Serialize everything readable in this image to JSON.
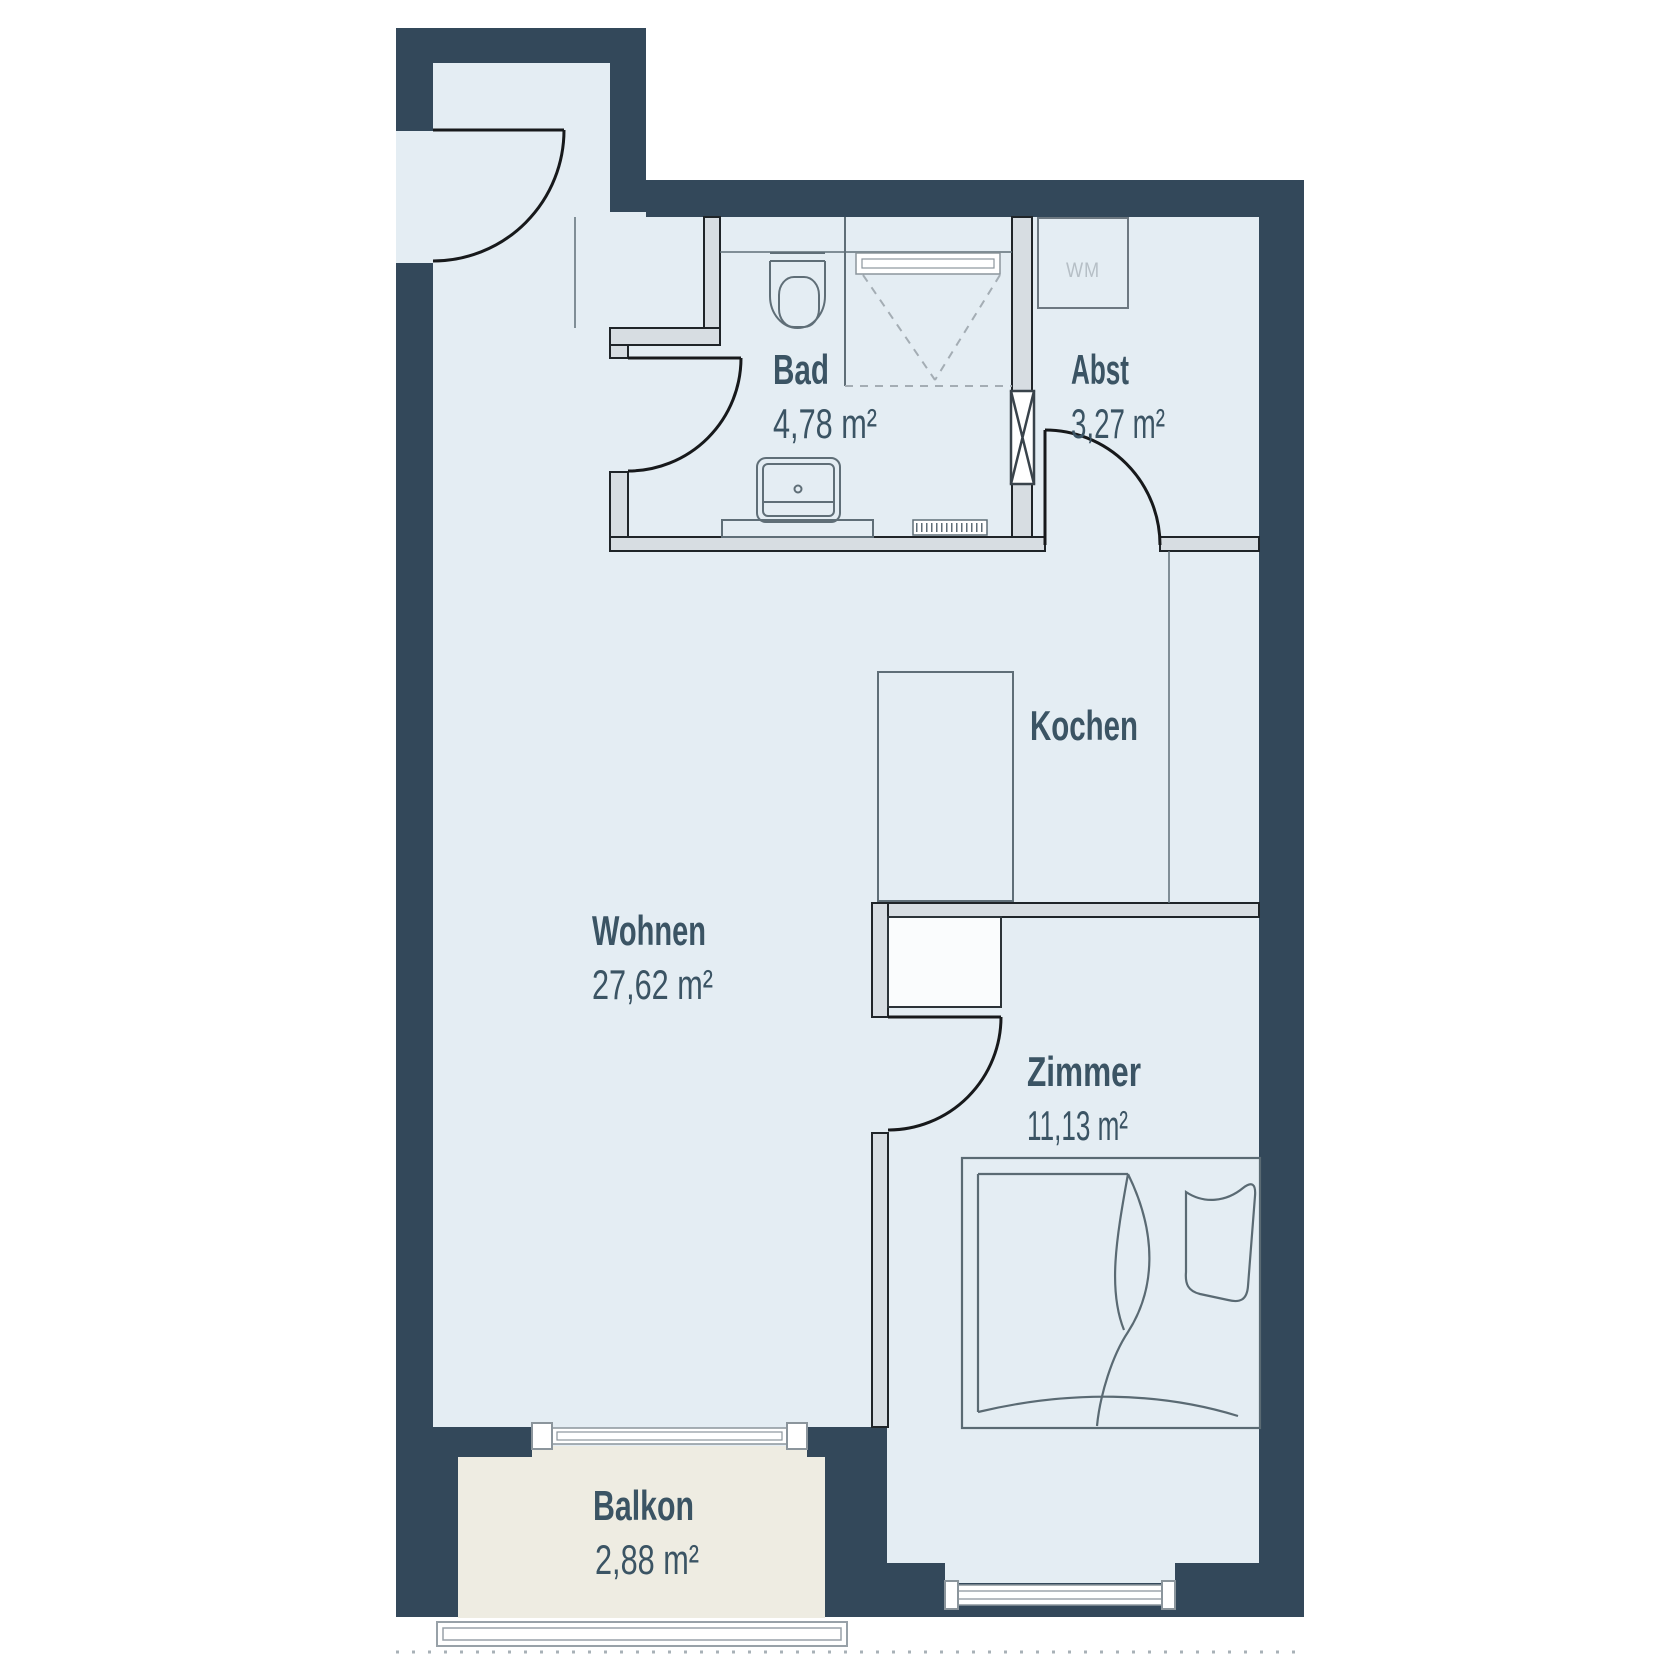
{
  "plan": {
    "rooms": [
      {
        "id": "bad",
        "name": "Bad",
        "area": "4,78 m²"
      },
      {
        "id": "abst",
        "name": "Abst",
        "area": "3,27 m²"
      },
      {
        "id": "kochen",
        "name": "Kochen"
      },
      {
        "id": "wohnen",
        "name": "Wohnen",
        "area": "27,62 m²"
      },
      {
        "id": "zimmer",
        "name": "Zimmer",
        "area": "11,13 m²"
      },
      {
        "id": "balkon",
        "name": "Balkon",
        "area": "2,88 m²"
      }
    ],
    "appliances": {
      "washing_machine_label": "WM"
    },
    "colors": {
      "wall": "#33485A",
      "floor": "#E4EDF3",
      "balcony_floor": "#EEECE2",
      "interior_wall": "#D7DDE2",
      "label_text": "#3B5464",
      "wm_text": "#B6BFC6",
      "fixture_line": "#5F6E77",
      "window_line": "#8B959C"
    }
  }
}
